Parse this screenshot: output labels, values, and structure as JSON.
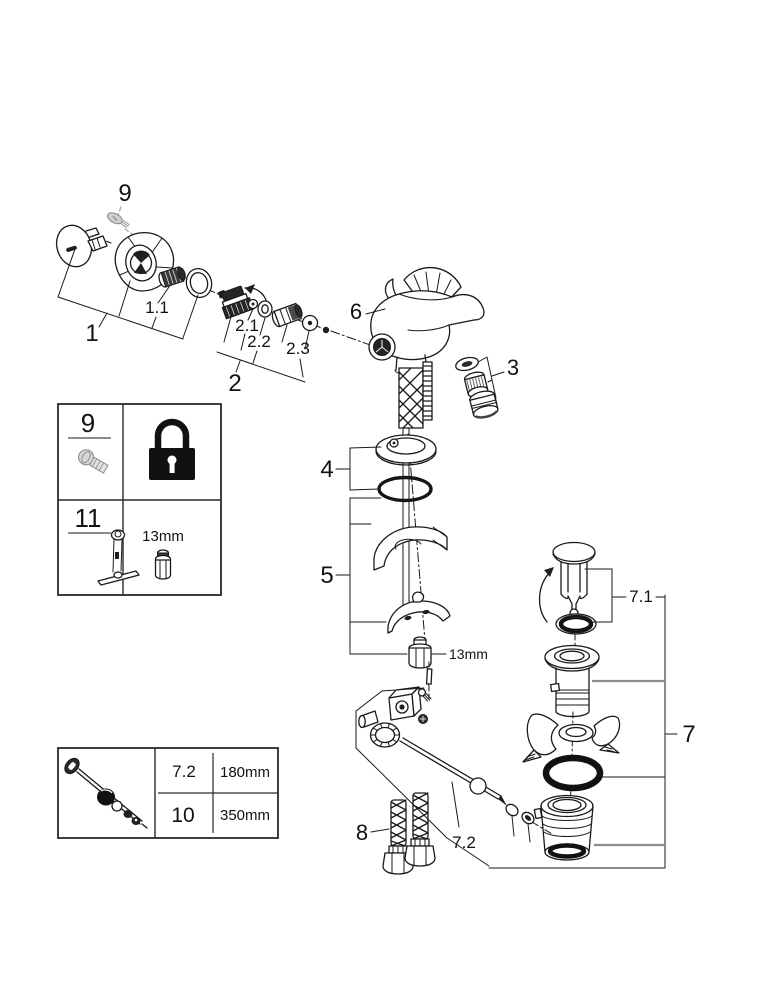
{
  "labels": {
    "screw_top": "9",
    "handle_group": "1",
    "handle_screw": "1.1",
    "cartridge_group": "2",
    "cartridge_ball": "2.1",
    "cartridge_seal": "2.2",
    "cartridge_spindle": "2.3",
    "aerator": "3",
    "rosette_group": "4",
    "mounting_group": "5",
    "body": "6",
    "drain_group": "7",
    "drain_plunger": "7.1",
    "drain_rod": "7.2",
    "hoses": "8",
    "nut_size": "13mm"
  },
  "legend": {
    "screw_item": "9",
    "tool_item": "11",
    "nut_size": "13mm"
  },
  "rod_table": {
    "rows": [
      {
        "ref": "7.2",
        "length": "180mm"
      },
      {
        "ref": "10",
        "length": "350mm"
      }
    ]
  }
}
